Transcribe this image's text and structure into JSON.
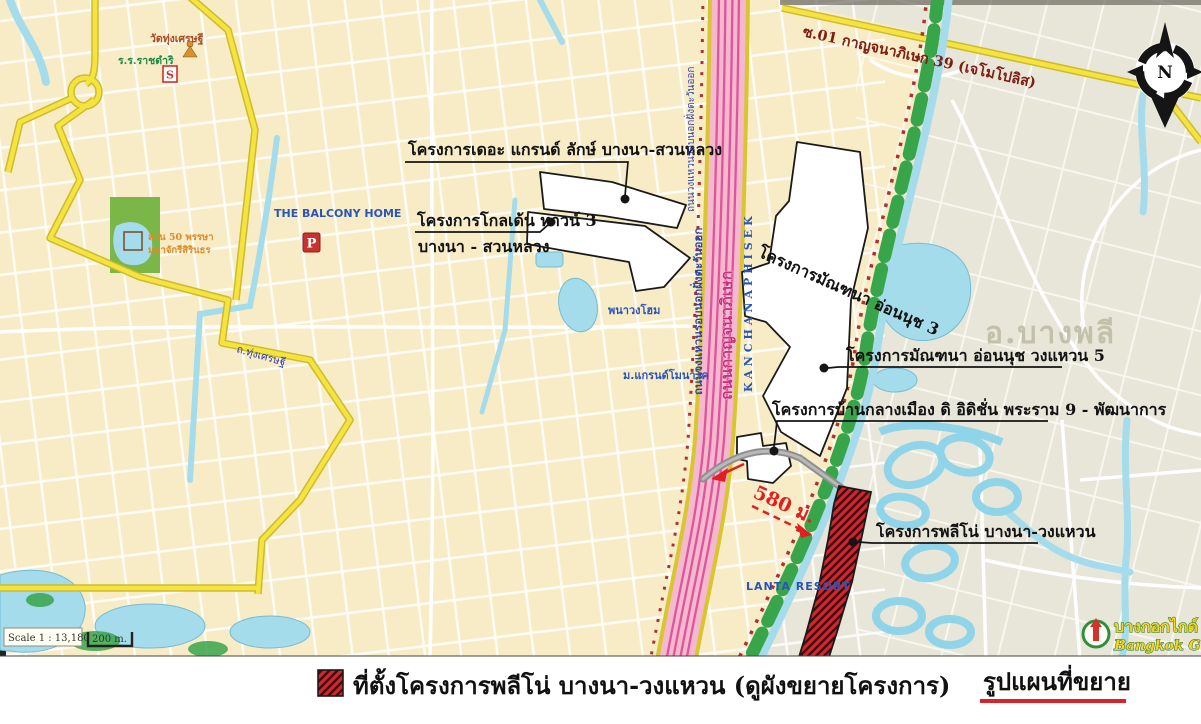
{
  "colors": {
    "site_red": "#d8232a",
    "highway_pink": "#f4b9ce",
    "road_yellow": "#f5e33f",
    "water_blue": "#a5dcec",
    "green_strip": "#38a54b",
    "cream_area": "#f8ecc6",
    "gray_area": "#e8e6d8"
  },
  "map": {
    "road_labels": {
      "kanchanaphisek_soi": "ซ.01 กาญจนาภิเษก 39 (เจโมโปลิส)",
      "ring_road_thai": "ถนนวงแหวนรอบนอกฝั่งตะวันออก",
      "kanchanaphisek_thai": "ถนนกาญจนาภิเษก",
      "kanchanaphisek_en": "KANCHANAPHISEK",
      "thung_setthi_road": "ถ.ทุ่งเศรษฐี"
    },
    "place_labels": {
      "district_watermark": "อ.บางพลี",
      "balcony_home": "THE BALCONY HOME",
      "lanta_resort": "LANTA RESORT",
      "temple": "วัดทุ่งเศรษฐี",
      "school": "ร.ร.ราชดำริ",
      "grand_monaco": "ม.แกรนด์โมนาโค",
      "phanawong_home": "พนาวงโฮม",
      "park_line1": "สวน 50 พรรษา",
      "park_line2": "มหาจักรีสิรินธร"
    },
    "projects": {
      "grand_luck": "โครงการเดอะ แกรนด์ ลักษ์ บางนา-สวนหลวง",
      "golden_town_line1": "โครงการโกลเด้น ทาวน์ 3",
      "golden_town_line2": "บางนา - สวนหลวง",
      "mantana_onnut3": "โครงการมัณฑนา อ่อนนุช 3",
      "mantana_wongwaen5": "โครงการมัณฑนา อ่อนนุช วงแหวน 5",
      "baan_klang_muang": "โครงการบ้านกลางเมือง ดิ อิดิชั่น พระราม 9 - พัฒนาการ",
      "pleno": "โครงการพลีโน่ บางนา-วงแหวน"
    },
    "distance_note": "580 ม.",
    "compass_letter": "N",
    "badges": {
      "parking": "P",
      "school_sign": "S"
    },
    "scale": {
      "text": "Scale 1 : 13,180",
      "bar": "200 m."
    },
    "publisher": {
      "thai": "บางกอกไกด์",
      "en": "Bangkok Guide"
    }
  },
  "legend": {
    "site_label": "ที่ตั้งโครงการพลีโน่ บางนา-วงแหวน (ดูผังขยายโครงการ)",
    "map_title": "รูปแผนที่ขยาย"
  }
}
